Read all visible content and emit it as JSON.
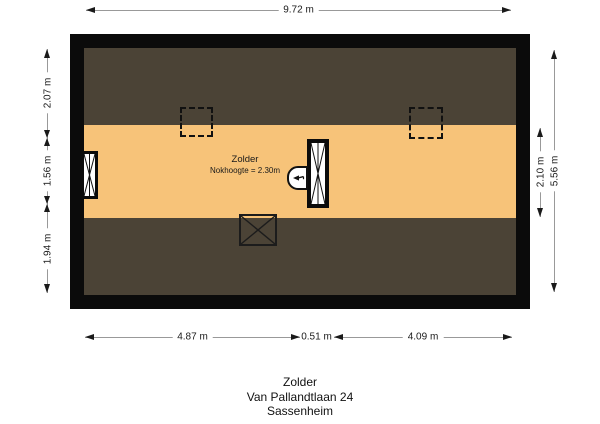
{
  "room": {
    "name": "Zolder",
    "note": "Nokhoogte = 2.30m"
  },
  "dimensions": {
    "top": "9.72 m",
    "bottom": [
      "4.87 m",
      "0.51 m",
      "4.09 m"
    ],
    "left": [
      "2.07 m",
      "1.56 m",
      "1.94 m"
    ],
    "right": [
      "2.10 m",
      "5.56 m"
    ]
  },
  "caption": {
    "line1": "Zolder",
    "line2": "Van Pallandtlaan 24",
    "line3": "Sassenheim"
  },
  "colors": {
    "floor": "#f7c379",
    "roof_slope": "#4b4336",
    "wall": "#0b0b0b",
    "dimension_line": "#999999",
    "text": "#1a1a1a",
    "background": "#ffffff"
  },
  "symbols": {
    "skylight_left": "skylight-dashed",
    "skylight_right": "skylight-dashed",
    "left_window": "window-cross",
    "center_shaft": "shaft-cross",
    "hatch": "hatch-arrow",
    "floor_opening": "crossed-opening"
  }
}
